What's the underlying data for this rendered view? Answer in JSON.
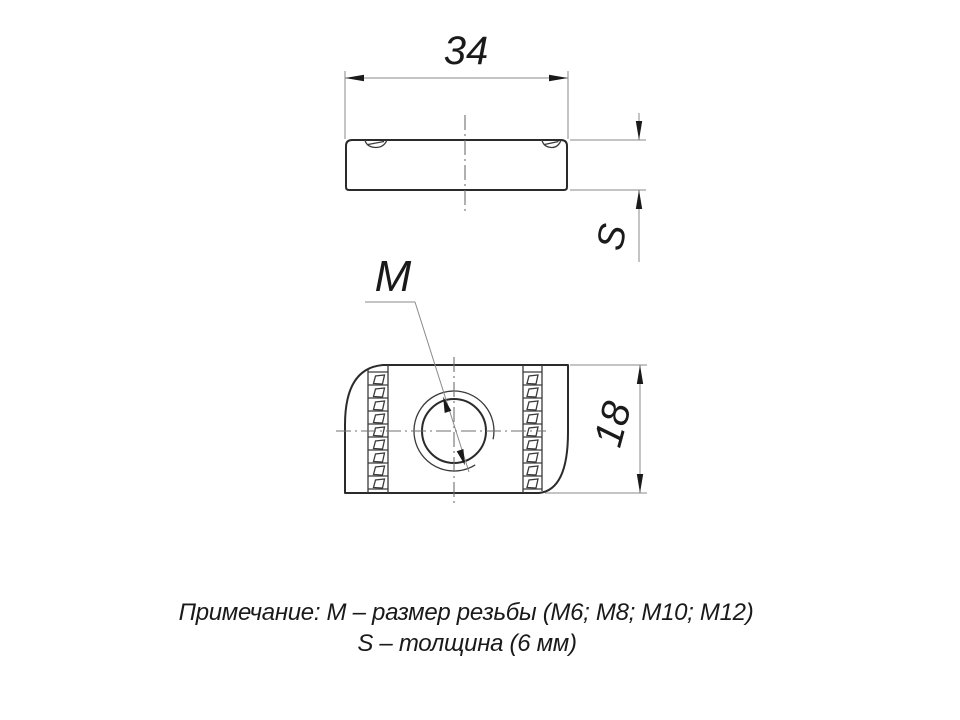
{
  "drawing": {
    "dimensions": {
      "width": "34",
      "thickness": "S",
      "height": "18",
      "thread": "M"
    },
    "note": {
      "line1": "Примечание: М – размер резьбы (М6; М8; М10; М12)",
      "line2": "S – толщина (6 мм)"
    },
    "colors": {
      "background": "#ffffff",
      "outline": "#2b2b2b",
      "thin_line": "#8a8a8a",
      "text": "#1a1a1a"
    }
  }
}
